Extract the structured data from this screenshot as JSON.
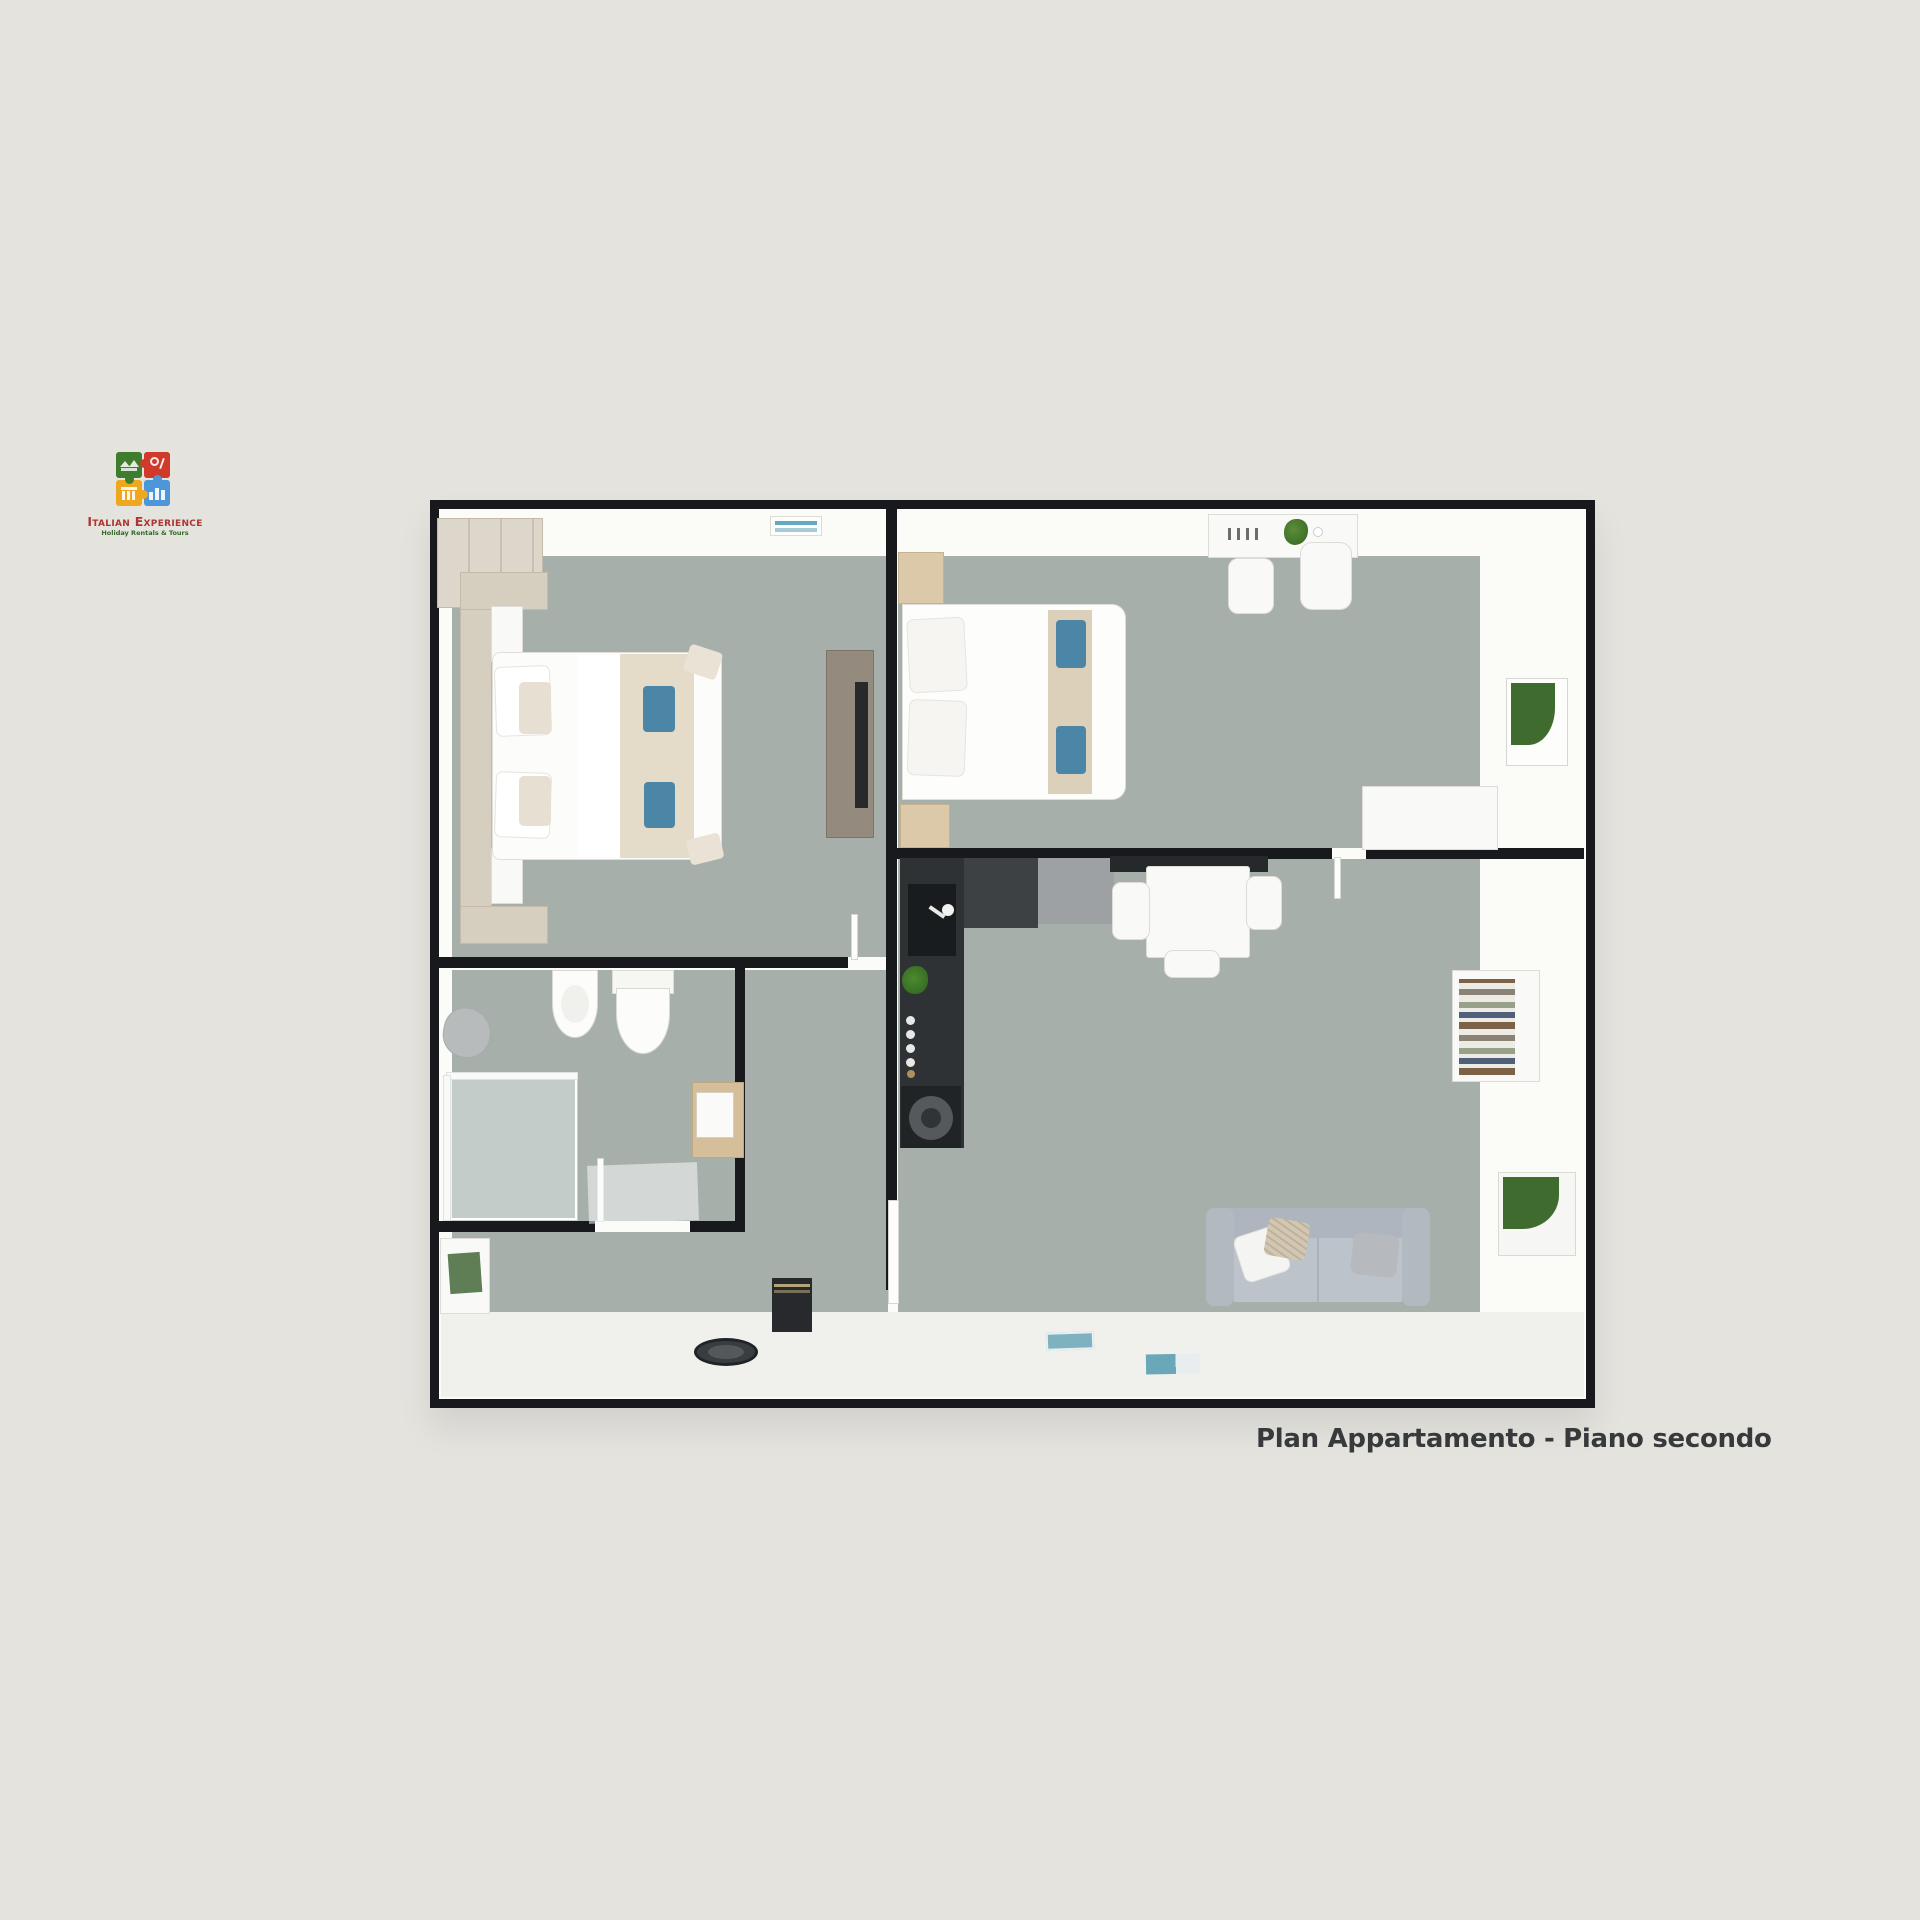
{
  "logo": {
    "brand": "Italian Experience",
    "tagline": "Holiday Rentals & Tours",
    "puzzle_colors": {
      "top_left": "#3e7d2e",
      "top_right": "#cf3a2b",
      "bottom_left": "#eea71e",
      "bottom_right": "#4d96d9"
    }
  },
  "caption": "Plan Appartamento - Piano secondo",
  "palette": {
    "page_bg": "#e4e3de",
    "wall_white": "#fbfbf8",
    "wall_line": "#17191c",
    "floor_sage": "#a6afaa",
    "floor_light": "#f0f1ed",
    "accent_blue": "#4b86a6",
    "kitchen_dark": "#2e3235",
    "picture_green": "#3f6b2e",
    "sofa_gray": "#b8bec6",
    "text_color": "#38393c",
    "brand_red": "#b03430",
    "brand_green": "#2f6b27"
  }
}
